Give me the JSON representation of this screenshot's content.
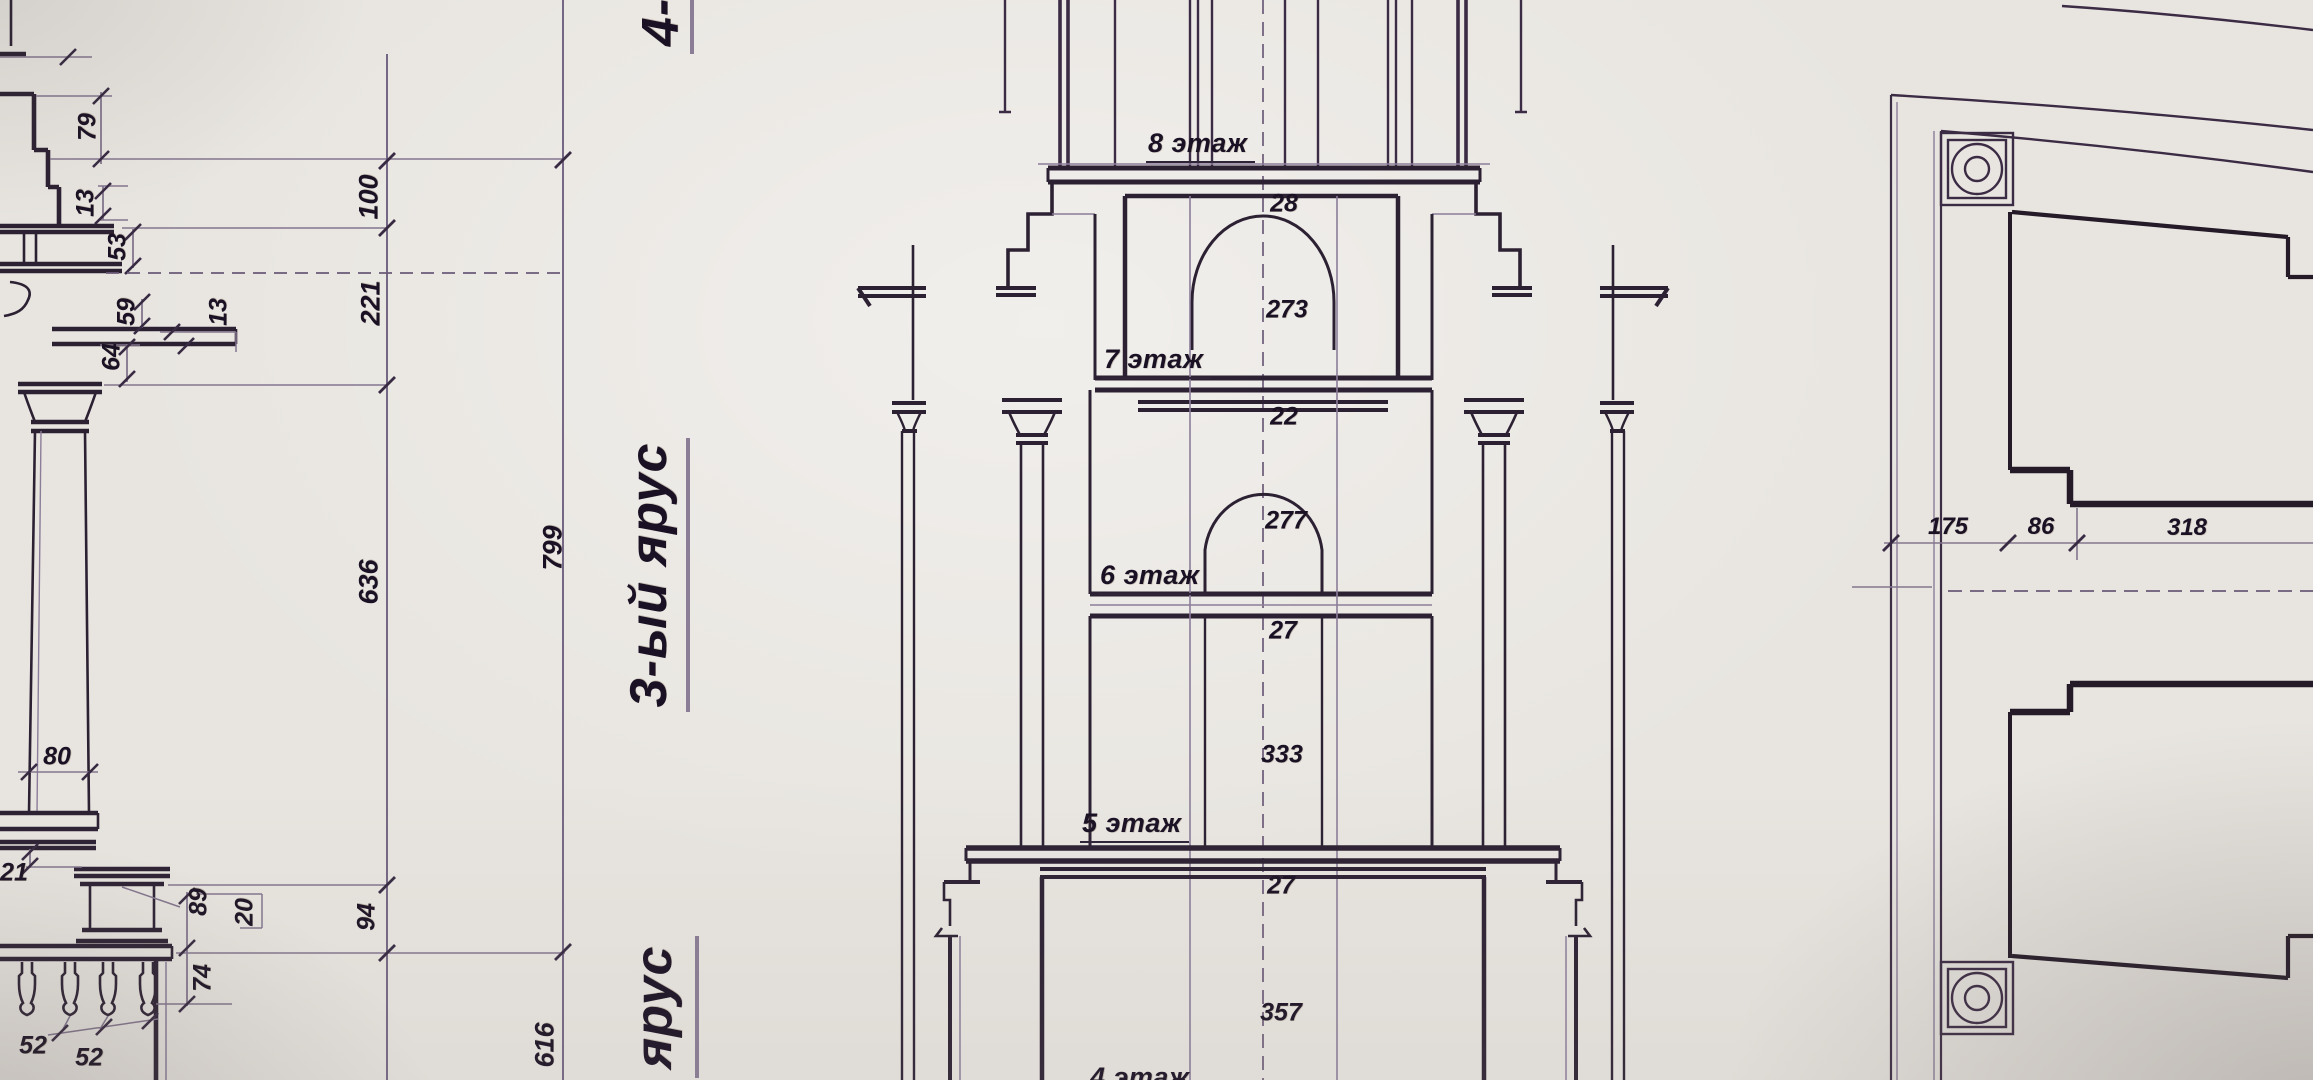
{
  "photo": {
    "paper_color": "#e8e5e0",
    "line_color": "#2c2133",
    "dim_line_color": "#83768e",
    "text_color": "#1a1124"
  },
  "titles": {
    "tier_top_partial": "4-",
    "tier_main": "3-ый ярус",
    "tier_bottom_partial": "ярус"
  },
  "left_dims": {
    "d79": "79",
    "d13a": "13",
    "d53": "53",
    "d59": "59",
    "d13b": "13",
    "d64": "64",
    "d100": "100",
    "d221": "221",
    "d636": "636",
    "d799": "799",
    "d616": "616",
    "d80": "80",
    "d21": "21",
    "d89": "89",
    "d20": "20",
    "d94": "94",
    "d74": "74",
    "d52a": "52",
    "d52b": "52"
  },
  "tower": {
    "floor_labels": [
      "8 этаж",
      "7 этаж",
      "6 этаж",
      "5 этаж",
      "4 этаж"
    ],
    "dims": {
      "d28": "28",
      "d273": "273",
      "d22": "22",
      "d277": "277",
      "d27a": "27",
      "d333": "333",
      "d27b": "27",
      "d357": "357"
    }
  },
  "plan": {
    "dims": {
      "d175": "175",
      "d86": "86",
      "d318": "318"
    }
  }
}
